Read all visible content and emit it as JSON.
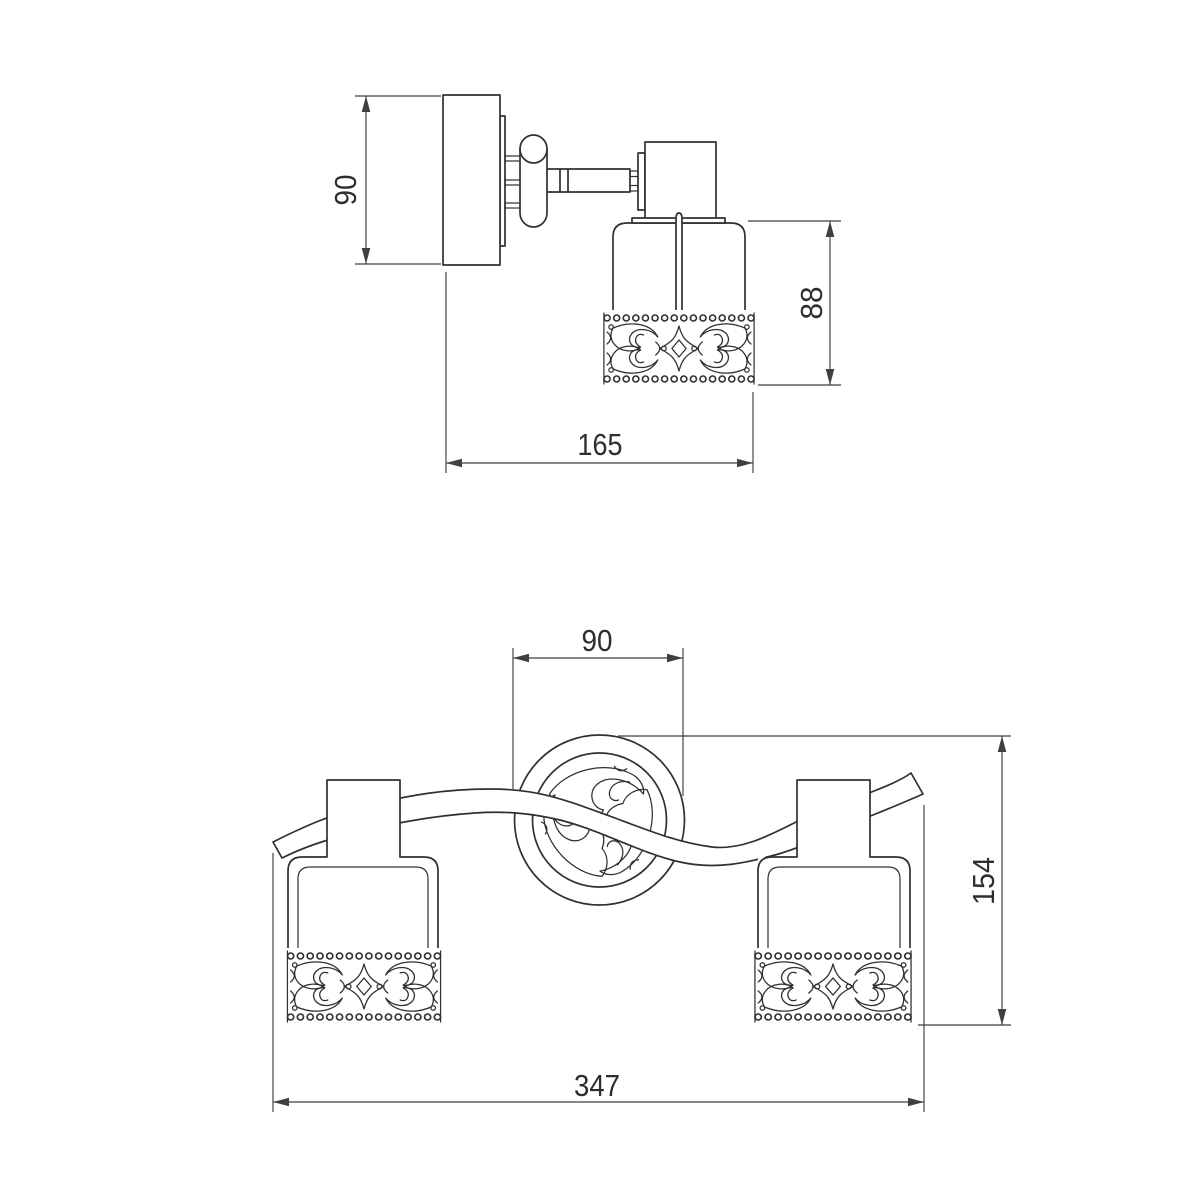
{
  "colors": {
    "background": "#ffffff",
    "object_line": "#303030",
    "dimension_line": "#3f3f3f",
    "text": "#2e2e2e"
  },
  "dims": {
    "side_height": "90",
    "side_shade_height": "88",
    "side_depth": "165",
    "front_canopy_width": "90",
    "front_height": "154",
    "front_width": "347"
  }
}
